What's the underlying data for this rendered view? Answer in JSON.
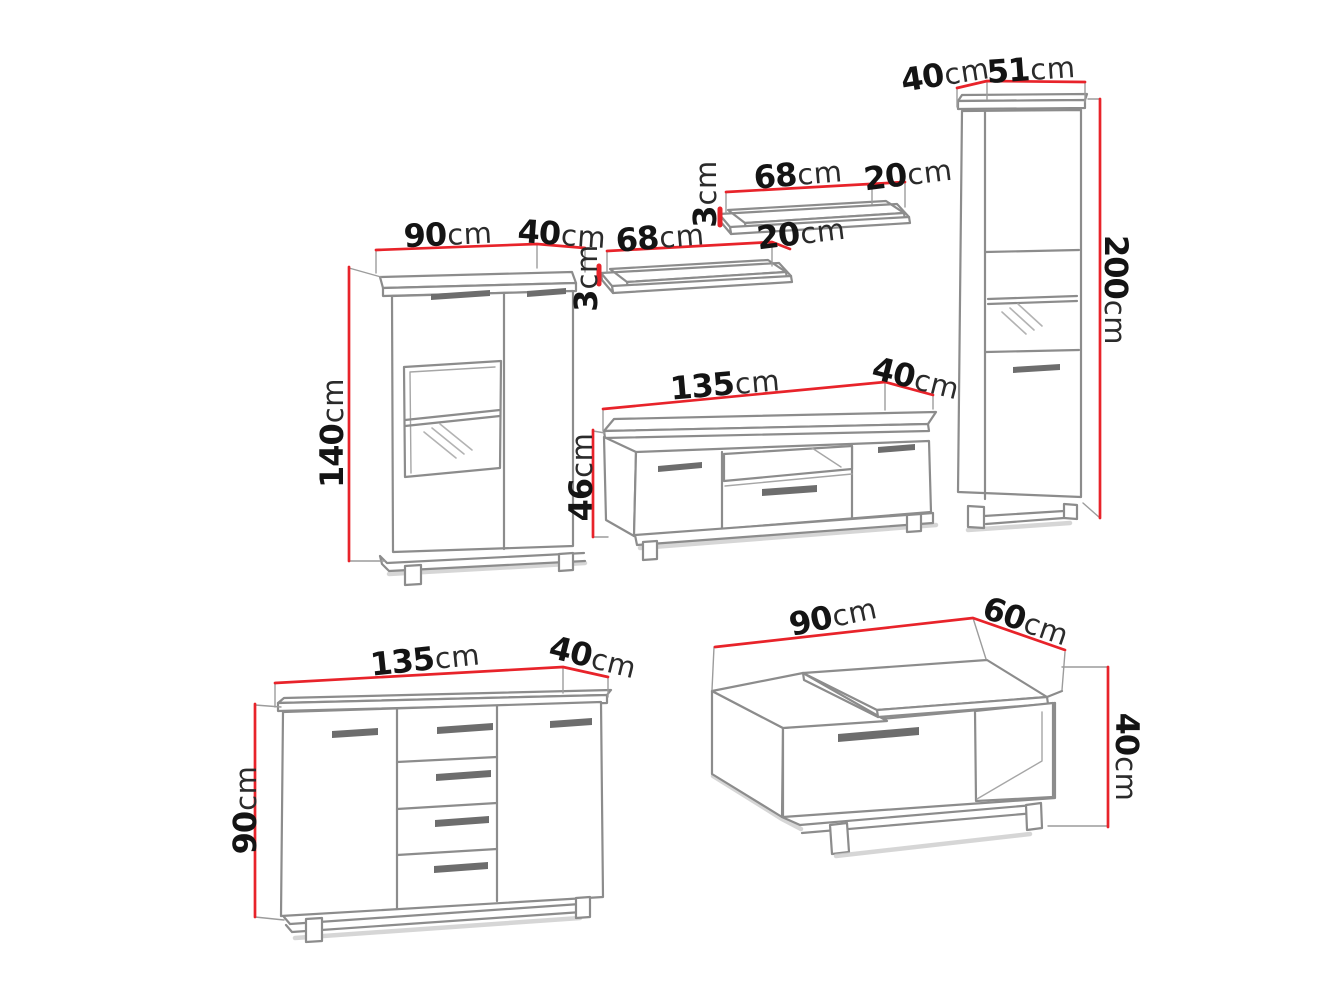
{
  "diagram": {
    "type": "furniture-dimension-drawing",
    "background": "#ffffff",
    "colors": {
      "dimension_line": "#e8232a",
      "sketch_line": "#8c8c8c",
      "label_text": "#1c1c1c"
    },
    "unit": "cm"
  },
  "furniture": {
    "display_cabinet": {
      "width": {
        "value": "90",
        "unit": "cm"
      },
      "depth": {
        "value": "40",
        "unit": "cm"
      },
      "height": {
        "value": "140",
        "unit": "cm"
      }
    },
    "wall_shelf_lower": {
      "width": {
        "value": "68",
        "unit": "cm"
      },
      "depth": {
        "value": "20",
        "unit": "cm"
      },
      "thickness": {
        "value": "3",
        "unit": "cm"
      }
    },
    "wall_shelf_upper": {
      "width": {
        "value": "68",
        "unit": "cm"
      },
      "depth": {
        "value": "20",
        "unit": "cm"
      },
      "thickness": {
        "value": "3",
        "unit": "cm"
      }
    },
    "tv_stand": {
      "width": {
        "value": "135",
        "unit": "cm"
      },
      "depth": {
        "value": "40",
        "unit": "cm"
      },
      "height": {
        "value": "46",
        "unit": "cm"
      }
    },
    "tall_cabinet": {
      "depth": {
        "value": "40",
        "unit": "cm"
      },
      "width": {
        "value": "51",
        "unit": "cm"
      },
      "height": {
        "value": "200",
        "unit": "cm"
      }
    },
    "sideboard": {
      "width": {
        "value": "135",
        "unit": "cm"
      },
      "depth": {
        "value": "40",
        "unit": "cm"
      },
      "height": {
        "value": "90",
        "unit": "cm"
      }
    },
    "coffee_table": {
      "width": {
        "value": "90",
        "unit": "cm"
      },
      "depth": {
        "value": "60",
        "unit": "cm"
      },
      "height": {
        "value": "40",
        "unit": "cm"
      }
    }
  }
}
